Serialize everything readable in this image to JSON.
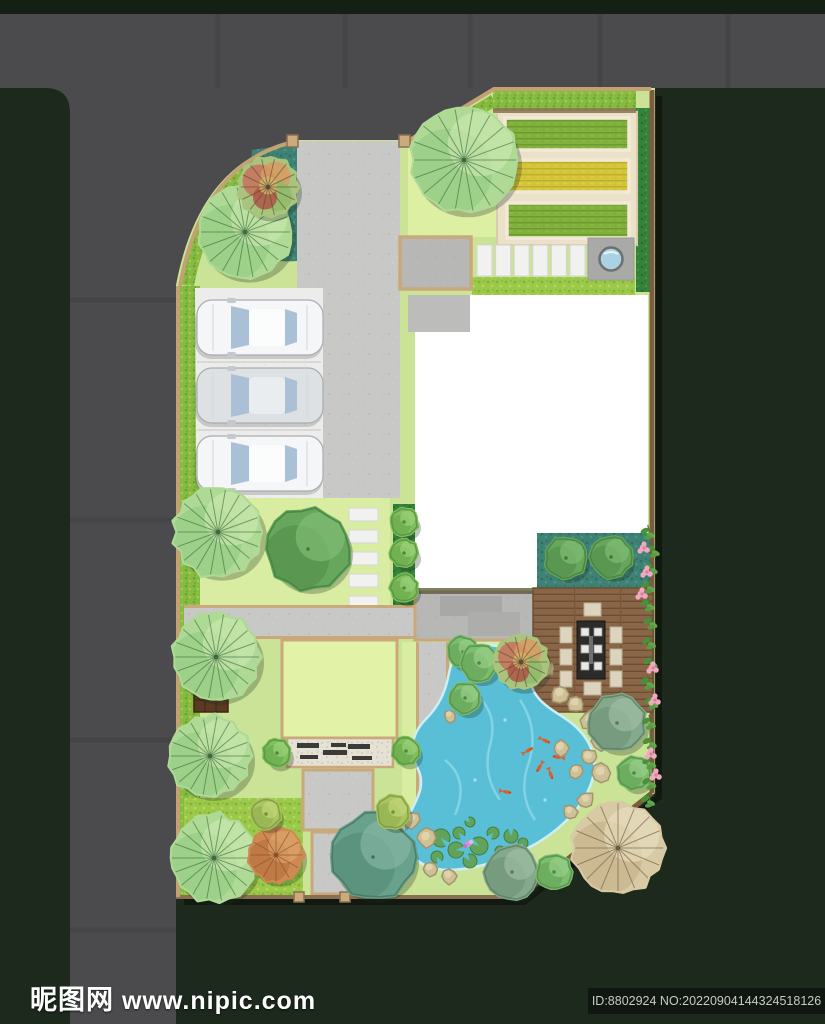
{
  "watermark": {
    "site_name": "昵图网",
    "site_url": "www.nipic.com",
    "id_text": "ID:8802924 NO:20220904144324518126"
  },
  "palette": {
    "background": "#1c291c",
    "top_strip": "#141f15",
    "road": "#4b4b4d",
    "lawn": "#cbe396",
    "lawn_bright": "#dcefa3",
    "hedge": "#86ba41",
    "hedge_deep": "#35823a",
    "teal_bed": "#3d8274",
    "tan_border": "#c9a87b",
    "wall_brown": "#7c5c40",
    "cream": "#ebe1c9",
    "concrete": "#c8c8c6",
    "parking_pad": "#ececea",
    "paver_white": "#f1f1ef",
    "bed_green": "#82b13d",
    "bed_yellow": "#d5c63d",
    "pond": "#58bfd6",
    "deck_wood": "#8a6648",
    "rock": "#cfc096",
    "house": "#ffffff",
    "table_dark": "#2b2b29",
    "chair": "#dcd4be",
    "car_white": "#f5f6f7",
    "car_silver": "#dde1e3",
    "car_glass": "#a9c0d6",
    "koi_orange": "#e25c28",
    "lily_green": "#63a254",
    "flower_pink": "#f2a8c0"
  },
  "scene": {
    "canvas": {
      "w": 825,
      "h": 1024
    },
    "trees": [
      {
        "k": "fan",
        "x": 245,
        "y": 232,
        "r": 47
      },
      {
        "k": "mixed",
        "x": 268,
        "y": 187,
        "r": 30
      },
      {
        "k": "fan",
        "x": 464,
        "y": 160,
        "r": 54
      },
      {
        "k": "fan",
        "x": 218,
        "y": 532,
        "r": 45
      },
      {
        "k": "dark",
        "x": 308,
        "y": 549,
        "r": 41
      },
      {
        "k": "fan",
        "x": 216,
        "y": 657,
        "r": 44
      },
      {
        "k": "fan",
        "x": 210,
        "y": 756,
        "r": 41
      },
      {
        "k": "fan",
        "x": 214,
        "y": 858,
        "r": 44
      },
      {
        "k": "round",
        "x": 463,
        "y": 652,
        "r": 15
      },
      {
        "k": "round",
        "x": 479,
        "y": 663,
        "r": 18
      },
      {
        "k": "round",
        "x": 465,
        "y": 698,
        "r": 15
      },
      {
        "k": "mixed",
        "x": 521,
        "y": 662,
        "r": 27
      },
      {
        "k": "gray",
        "x": 617,
        "y": 723,
        "r": 28
      },
      {
        "k": "round",
        "x": 634,
        "y": 773,
        "r": 16
      },
      {
        "k": "teal",
        "x": 373,
        "y": 857,
        "r": 42
      },
      {
        "k": "yellow",
        "x": 393,
        "y": 812,
        "r": 16
      },
      {
        "k": "orange",
        "x": 276,
        "y": 855,
        "r": 27
      },
      {
        "k": "yellow",
        "x": 266,
        "y": 814,
        "r": 14
      },
      {
        "k": "gray",
        "x": 512,
        "y": 872,
        "r": 26
      },
      {
        "k": "round",
        "x": 554,
        "y": 872,
        "r": 17
      },
      {
        "k": "tanfan",
        "x": 618,
        "y": 848,
        "r": 46
      },
      {
        "k": "dark",
        "x": 566,
        "y": 558,
        "r": 20
      },
      {
        "k": "dark",
        "x": 611,
        "y": 557,
        "r": 20
      },
      {
        "k": "shrub",
        "x": 277,
        "y": 753,
        "r": 13
      },
      {
        "k": "shrub",
        "x": 406,
        "y": 751,
        "r": 13
      },
      {
        "k": "shrub",
        "x": 404,
        "y": 522,
        "r": 13
      },
      {
        "k": "shrub",
        "x": 404,
        "y": 553,
        "r": 13
      },
      {
        "k": "shrub",
        "x": 404,
        "y": 588,
        "r": 13
      }
    ],
    "cars": [
      {
        "x": 197,
        "y": 300,
        "tone": "white"
      },
      {
        "x": 197,
        "y": 368,
        "tone": "silver"
      },
      {
        "x": 197,
        "y": 436,
        "tone": "white"
      }
    ],
    "koi": [
      [
        546,
        741,
        25
      ],
      [
        557,
        757,
        190
      ],
      [
        539,
        768,
        120
      ],
      [
        551,
        775,
        70
      ],
      [
        529,
        750,
        330
      ],
      [
        507,
        792,
        10
      ]
    ],
    "lily_pads": [
      [
        441,
        838,
        9
      ],
      [
        456,
        850,
        8
      ],
      [
        470,
        861,
        7
      ],
      [
        437,
        857,
        6
      ],
      [
        459,
        833,
        6
      ],
      [
        479,
        846,
        9
      ],
      [
        493,
        833,
        6
      ],
      [
        470,
        822,
        5
      ],
      [
        500,
        851,
        5
      ],
      [
        511,
        836,
        7
      ],
      [
        523,
        843,
        5
      ]
    ],
    "lily_flower": [
      468,
      844
    ],
    "rocks": [
      [
        560,
        694,
        9
      ],
      [
        576,
        704,
        8
      ],
      [
        591,
        720,
        10
      ],
      [
        601,
        741,
        9
      ],
      [
        589,
        757,
        8
      ],
      [
        601,
        773,
        9
      ],
      [
        576,
        771,
        7
      ],
      [
        561,
        748,
        8
      ],
      [
        547,
        669,
        7
      ],
      [
        533,
        657,
        6
      ],
      [
        412,
        820,
        8
      ],
      [
        426,
        838,
        9
      ],
      [
        408,
        856,
        8
      ],
      [
        430,
        869,
        7
      ],
      [
        449,
        876,
        8
      ],
      [
        586,
        800,
        8
      ],
      [
        570,
        812,
        7
      ],
      [
        596,
        836,
        9
      ],
      [
        460,
        706,
        7
      ],
      [
        450,
        716,
        6
      ]
    ],
    "vine_leaf_ys": [
      532,
      550,
      568,
      586,
      604,
      622,
      642,
      662,
      682,
      702,
      722,
      742,
      762,
      782,
      800
    ],
    "vine_x": 651,
    "flower_clusters": [
      [
        643,
        548
      ],
      [
        646,
        572
      ],
      [
        641,
        594
      ],
      [
        652,
        668
      ],
      [
        654,
        700
      ],
      [
        650,
        754
      ],
      [
        655,
        775
      ]
    ],
    "gravel_planks": [
      [
        297,
        743,
        22,
        5
      ],
      [
        323,
        750,
        24,
        5
      ],
      [
        300,
        755,
        18,
        4
      ],
      [
        348,
        744,
        22,
        5
      ],
      [
        352,
        756,
        20,
        4
      ],
      [
        331,
        743,
        15,
        4
      ]
    ],
    "pavers_row": {
      "x0": 477,
      "y": 245,
      "w": 15,
      "h": 31,
      "dx": 18.6,
      "count": 6
    },
    "pavers_col": {
      "x": 349,
      "y0": 508,
      "w": 29,
      "h": 13,
      "dy": 22,
      "count": 5
    },
    "small_pads": [
      [
        452,
        659,
        13,
        13
      ],
      [
        452,
        741,
        13,
        13
      ]
    ],
    "gate_posts": [
      [
        287,
        135,
        11,
        12
      ],
      [
        399,
        135,
        11,
        12
      ],
      [
        294,
        892,
        10,
        10
      ],
      [
        340,
        892,
        10,
        10
      ]
    ],
    "veg_beds": [
      {
        "x": 505,
        "y": 118,
        "w": 124,
        "h": 32,
        "type": "green"
      },
      {
        "x": 505,
        "y": 160,
        "w": 124,
        "h": 32,
        "type": "yellow"
      },
      {
        "x": 507,
        "y": 203,
        "w": 122,
        "h": 35,
        "type": "green"
      }
    ]
  }
}
